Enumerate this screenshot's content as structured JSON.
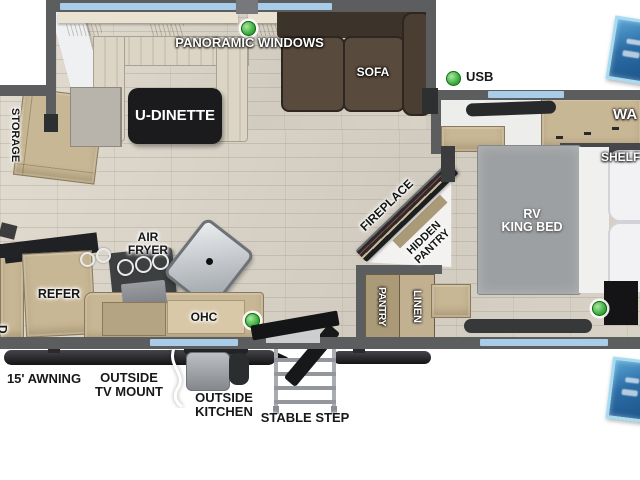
{
  "title": "RV travel trailer floor plan",
  "labels": {
    "panoramic_windows": "PANORAMIC WINDOWS",
    "u_dinette": "U-DINETTE",
    "sofa": "SOFA",
    "usb": "USB",
    "storage": "STORAGE",
    "wardrobe_partial": "WA",
    "shelf": "SHELF",
    "rv_king_bed": [
      "RV",
      "KING BED"
    ],
    "fireplace": "FIREPLACE",
    "hidden_pantry": [
      "HIDDEN",
      "PANTRY"
    ],
    "pantry": "PANTRY",
    "linen": "LINEN",
    "air_fryer": [
      "AIR",
      "FRYER"
    ],
    "refer": "REFER",
    "ohc": "OHC",
    "edge_partial": "D",
    "awning_15": "15' AWNING",
    "outside_tv_mount": [
      "OUTSIDE",
      "TV MOUNT"
    ],
    "outside_kitchen": [
      "OUTSIDE",
      "KITCHEN"
    ],
    "stable_step": "STABLE STEP"
  },
  "indicators": {
    "green_dots": [
      {
        "name": "panoramic-windows-led"
      },
      {
        "name": "usb-port"
      },
      {
        "name": "kitchen-led"
      },
      {
        "name": "bedroom-led"
      }
    ]
  },
  "colors": {
    "wall": "#5c5d5f",
    "window-blue": "#a9cde9",
    "floor": "#d8d2c7",
    "cabinet": "#c8b795",
    "cabinet-dark": "#ab9a78",
    "sofa-brown": "#584a3c",
    "bed-gray": "#9da0a2",
    "table-black": "#1b1b1d",
    "led-green": "#3fae3f",
    "badge-blue": "#2c6da6"
  }
}
